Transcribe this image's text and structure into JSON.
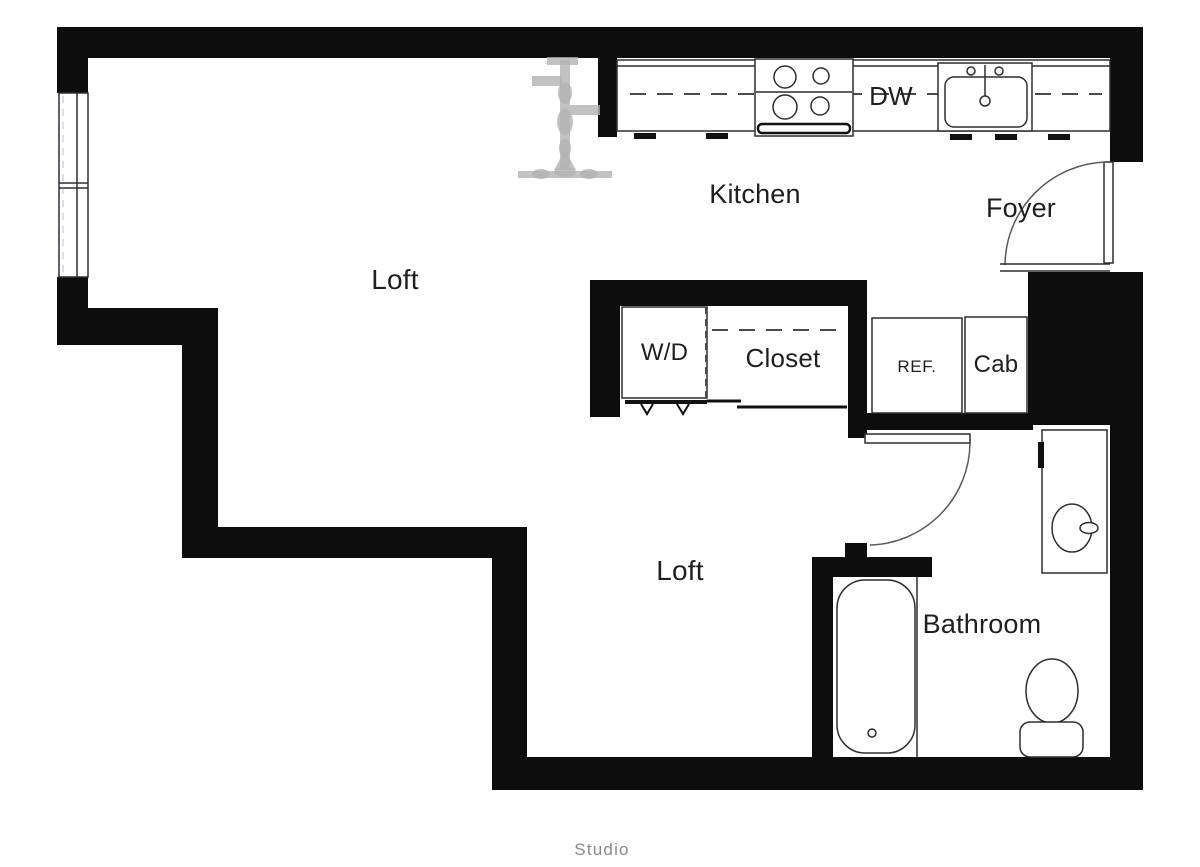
{
  "plan": {
    "title": "Studio",
    "rooms": {
      "loft_upper": "Loft",
      "kitchen": "Kitchen",
      "foyer": "Foyer",
      "loft_lower": "Loft",
      "bathroom": "Bathroom"
    },
    "fixtures": {
      "washer_dryer": "W/D",
      "closet": "Closet",
      "refrigerator": "REF.",
      "cabinet": "Cab",
      "dishwasher": "DW"
    },
    "colors": {
      "wall": "#0d0d0d",
      "fixture_line": "#2e2e2e",
      "label_text": "#1f1f1f",
      "title_text": "#8a8a8a",
      "sketch_gray": "#b3b3b3",
      "background": "#ffffff"
    }
  }
}
